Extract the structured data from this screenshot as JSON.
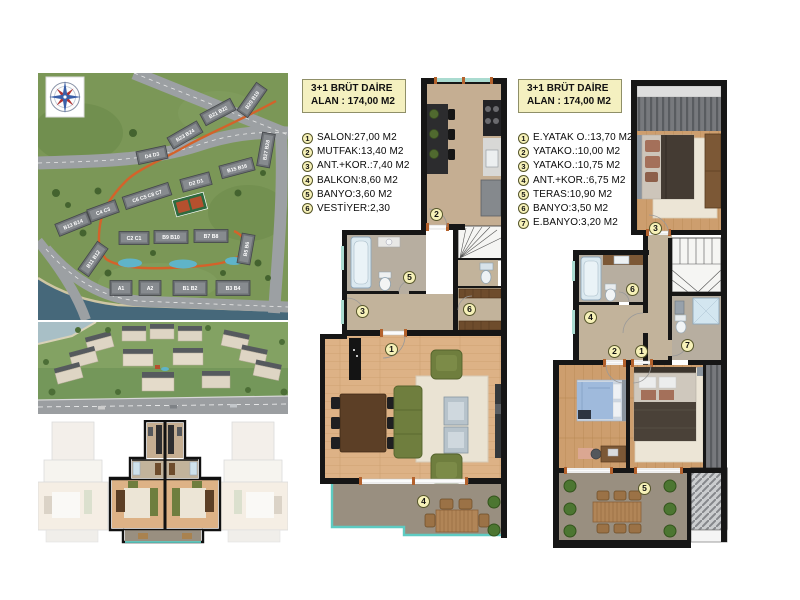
{
  "legend_a": {
    "title_line1": "3+1 BRÜT DAİRE",
    "title_line2": "ALAN : 174,00 M2",
    "items": [
      {
        "num": "1",
        "label": "SALON:27,00 M2"
      },
      {
        "num": "2",
        "label": "MUTFAK:13,40 M2"
      },
      {
        "num": "3",
        "label": "ANT.+KOR.:7,40 M2"
      },
      {
        "num": "4",
        "label": "BALKON:8,60 M2"
      },
      {
        "num": "5",
        "label": "BANYO:3,60 M2"
      },
      {
        "num": "6",
        "label": "VESTİYER:2,30"
      }
    ]
  },
  "legend_b": {
    "title_line1": "3+1 BRÜT DAİRE",
    "title_line2": "ALAN : 174,00 M2",
    "items": [
      {
        "num": "1",
        "label": "E.YATAK O.:13,70 M2"
      },
      {
        "num": "2",
        "label": "YATAKO.:10,00 M2"
      },
      {
        "num": "3",
        "label": "YATAKO.:10,75 M2"
      },
      {
        "num": "4",
        "label": "ANT.+KOR.:6,75 M2"
      },
      {
        "num": "5",
        "label": "TERAS:10,90 M2"
      },
      {
        "num": "6",
        "label": "BANYO:3,50 M2"
      },
      {
        "num": "7",
        "label": "E.BANYO:3,20 M2"
      }
    ]
  },
  "plan_a": {
    "markers": [
      {
        "num": "1"
      },
      {
        "num": "2"
      },
      {
        "num": "3"
      },
      {
        "num": "4"
      },
      {
        "num": "5"
      },
      {
        "num": "6"
      }
    ]
  },
  "plan_b": {
    "markers": [
      {
        "num": "1"
      },
      {
        "num": "2"
      },
      {
        "num": "3"
      },
      {
        "num": "4"
      },
      {
        "num": "5"
      },
      {
        "num": "6"
      },
      {
        "num": "7"
      }
    ]
  },
  "site_plan": {
    "buildings": [
      {
        "label": "B20 B19",
        "x": 214,
        "y": 27,
        "rot": -55,
        "w": 34,
        "h": 13
      },
      {
        "label": "B21 B22",
        "x": 180,
        "y": 39,
        "rot": -28,
        "w": 34,
        "h": 13
      },
      {
        "label": "B23 B24",
        "x": 147,
        "y": 62,
        "rot": -30,
        "w": 34,
        "h": 13
      },
      {
        "label": "D4 D3",
        "x": 114,
        "y": 82,
        "rot": -12,
        "w": 30,
        "h": 13
      },
      {
        "label": "B27 B28",
        "x": 228,
        "y": 77,
        "rot": -80,
        "w": 34,
        "h": 13
      },
      {
        "label": "B15 B16",
        "x": 199,
        "y": 95,
        "rot": -15,
        "w": 34,
        "h": 13
      },
      {
        "label": "D2 D1",
        "x": 158,
        "y": 109,
        "rot": -15,
        "w": 30,
        "h": 13
      },
      {
        "label": "C6 C5 C8 C7",
        "x": 109,
        "y": 123,
        "rot": -18,
        "w": 48,
        "h": 13
      },
      {
        "label": "C4 C3",
        "x": 65,
        "y": 138,
        "rot": -20,
        "w": 30,
        "h": 13
      },
      {
        "label": "B13 B14",
        "x": 35,
        "y": 151,
        "rot": -22,
        "w": 34,
        "h": 13
      },
      {
        "label": "C2 C1",
        "x": 96,
        "y": 165,
        "rot": 0,
        "w": 30,
        "h": 13
      },
      {
        "label": "B9 B10",
        "x": 133,
        "y": 164,
        "rot": 0,
        "w": 34,
        "h": 13
      },
      {
        "label": "B7 B8",
        "x": 173,
        "y": 163,
        "rot": 0,
        "w": 34,
        "h": 13
      },
      {
        "label": "B5 B6",
        "x": 208,
        "y": 176,
        "rot": -80,
        "w": 30,
        "h": 13
      },
      {
        "label": "B11 B12",
        "x": 55,
        "y": 186,
        "rot": -55,
        "w": 34,
        "h": 13
      },
      {
        "label": "A1",
        "x": 83,
        "y": 215,
        "rot": 0,
        "w": 22,
        "h": 15
      },
      {
        "label": "A2",
        "x": 112,
        "y": 215,
        "rot": 0,
        "w": 22,
        "h": 15
      },
      {
        "label": "B1 B2",
        "x": 152,
        "y": 215,
        "rot": 0,
        "w": 34,
        "h": 15
      },
      {
        "label": "B3 B4",
        "x": 195,
        "y": 215,
        "rot": 0,
        "w": 34,
        "h": 15
      }
    ]
  },
  "colors": {
    "wall": "#161616",
    "legend_bg": "#f4f0c0",
    "marker_bg": "#f6f1b8",
    "window_teal": "#aadbd0",
    "balcony_edge_teal": "#5ecbc2",
    "wood_floor": "#ddb286",
    "hall_floor": "#c2b39b",
    "bath_floor": "#b7aea0",
    "terrace_floor": "#998f80",
    "sofa_green": "#6f7e3e",
    "door_jamb_orange": "#b4622d",
    "site_path_orange": "#d4622a"
  }
}
